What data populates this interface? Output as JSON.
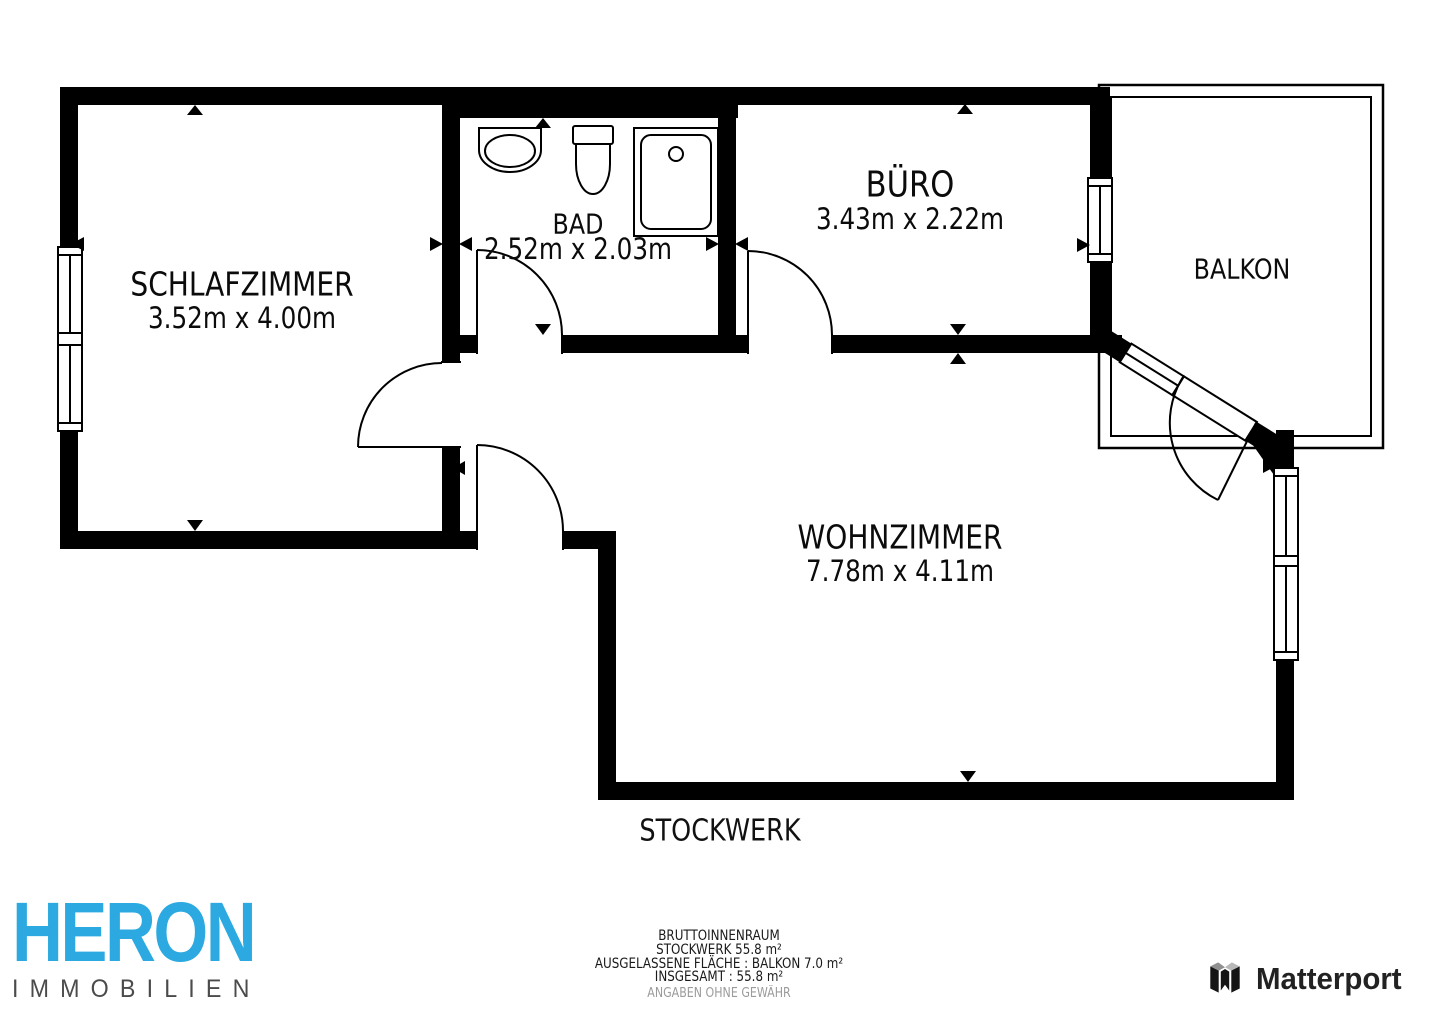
{
  "plan": {
    "title": "STOCKWERK",
    "wall_color": "#000000",
    "rooms": [
      {
        "id": "schlafzimmer",
        "name": "SCHLAFZIMMER",
        "dims": "3.52m x 4.00m"
      },
      {
        "id": "bad",
        "name": "BAD",
        "dims": "2.52m x 2.03m"
      },
      {
        "id": "buero",
        "name": "BÜRO",
        "dims": "3.43m x 2.22m"
      },
      {
        "id": "balkon",
        "name": "BALKON",
        "dims": ""
      },
      {
        "id": "wohnzimmer",
        "name": "WOHNZIMMER",
        "dims": "7.78m x 4.11m"
      }
    ]
  },
  "footer": {
    "summary": {
      "line1": "BRUTTOINNENRAUM",
      "line2": "STOCKWERK 55.8 m²",
      "line3": "AUSGELASSENE FLÄCHE :  BALKON 7.0 m²",
      "line4": "INSGESAMT :  55.8 m²",
      "disclaimer": "ANGABEN OHNE GEWÄHR"
    },
    "brand": {
      "name": "HERON",
      "subtitle": "IMMOBILIEN",
      "color": "#2BA9E0"
    },
    "matterport": {
      "label": "Matterport"
    }
  }
}
